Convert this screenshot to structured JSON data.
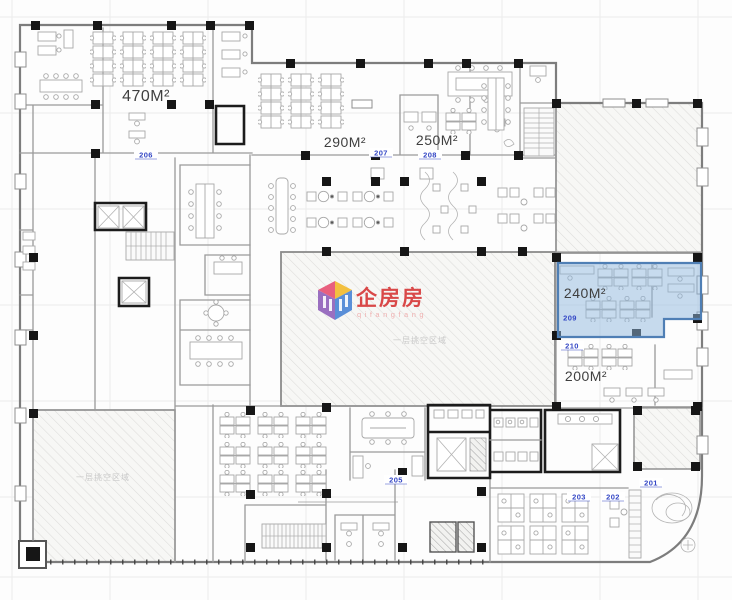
{
  "plan": {
    "type": "office-floor-plan",
    "highlighted_room": "209"
  },
  "colors": {
    "room_highlight_fill": "#8fb8dd",
    "room_highlight_stroke": "#4f7fb5",
    "room_tag_blue": "#3346c5",
    "area_label_gray": "#3f3f3f",
    "watermark_red": "#d94848",
    "watermark_pink": "#efb0b0",
    "hatch_gray": "#dddcda",
    "wall_gray": "#7d7d7d",
    "column_black": "#161616"
  },
  "rooms": {
    "206": {
      "number": "206",
      "area": "470M²",
      "highlighted": false
    },
    "207": {
      "number": "207",
      "area": "290M²",
      "highlighted": false
    },
    "208": {
      "number": "208",
      "area": "250M²",
      "highlighted": false
    },
    "209": {
      "number": "209",
      "area": "240M²",
      "highlighted": true
    },
    "210": {
      "number": "210",
      "area": "200M²",
      "highlighted": false
    },
    "205": {
      "number": "205",
      "highlighted": false
    },
    "203": {
      "number": "203",
      "highlighted": false
    },
    "202": {
      "number": "202",
      "highlighted": false
    },
    "201": {
      "number": "201",
      "highlighted": false
    }
  },
  "watermark": {
    "brand": "企房房",
    "romanized": "qifangfang"
  },
  "annotations": {
    "center_void": "一层挑空区域",
    "left_void": "一层挑空区域"
  }
}
